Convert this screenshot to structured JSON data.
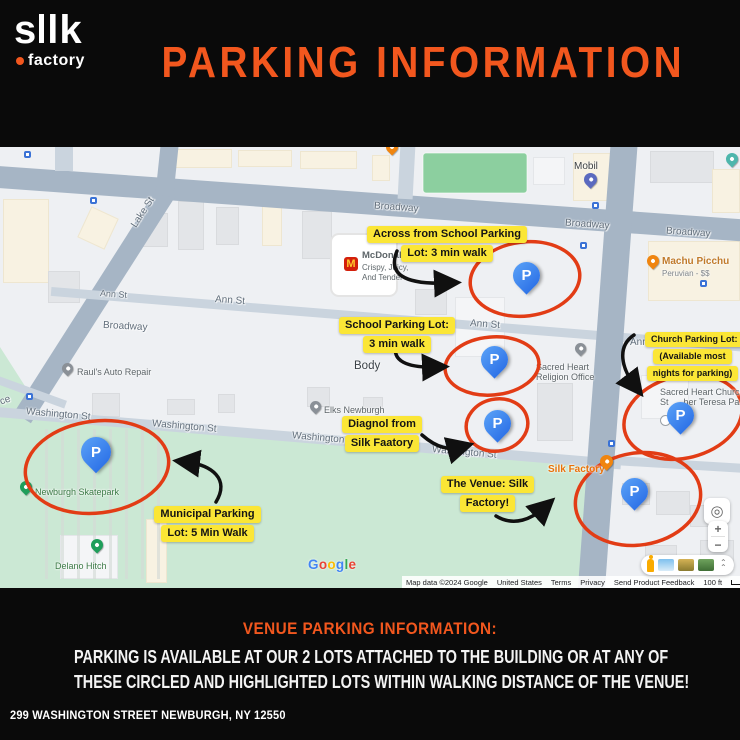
{
  "colors": {
    "accent_orange": "#f2571e",
    "highlight_yellow": "#fbe636",
    "circle_red": "#e23c15",
    "parking_pin_blue": "#4285f4"
  },
  "header": {
    "logo_word_left": "s",
    "logo_word_right": "lk",
    "logo_sub": "factory",
    "title": "PARKING INFORMATION"
  },
  "map": {
    "streets": {
      "broadway": "Broadway",
      "lake": "Lake St",
      "ann": "Ann St",
      "ann_short": "Ann",
      "washington": "Washington St",
      "partial_left": "ce"
    },
    "pois": {
      "mobil": {
        "name": "Mobil"
      },
      "mcdonalds": {
        "name": "McDonald's",
        "line2": "Crispy, Juicy,",
        "line3": "And Tender",
        "icon_letter": "M"
      },
      "machu_picchu": {
        "name": "Machu Picchu",
        "subtitle": "Peruvian - $$"
      },
      "rauls": {
        "name": "Raul's Auto Repair"
      },
      "elks": {
        "name": "Elks Newburgh"
      },
      "sacred_heart_office": {
        "line1": "Sacred Heart",
        "line2": "Religion Office"
      },
      "sacred_heart_church": {
        "line1": "Sacred Heart Church",
        "line2": "St      her Teresa Pa"
      },
      "silk_factory": {
        "name": "Silk Factory"
      },
      "skatepark": {
        "name": "Newburgh Skatepark"
      },
      "delano": {
        "name": "Delano Hitch"
      },
      "body": {
        "name": "Body"
      }
    },
    "parking_pin_letter": "P",
    "annotations": {
      "across": {
        "lines": [
          "Across from School Parking",
          "Lot: 3 min walk"
        ]
      },
      "school": {
        "lines": [
          "School Parking Lot:",
          "3 min walk"
        ]
      },
      "church": {
        "lines": [
          "Church Parking Lot:",
          "(Available most",
          "nights for parking)"
        ]
      },
      "diagnol": {
        "lines": [
          "Diagnol from",
          "Silk Faatory"
        ]
      },
      "venue": {
        "lines": [
          "The Venue: Silk",
          "Factory!"
        ]
      },
      "municipal": {
        "lines": [
          "Municipal Parking",
          "Lot: 5 Min Walk"
        ]
      }
    },
    "controls": {
      "zoom_in": "+",
      "zoom_out": "−",
      "collapse": "⌃"
    },
    "watermark": "Google",
    "attribution": {
      "map_data": "Map data ©2024 Google",
      "region": "United States",
      "terms": "Terms",
      "privacy": "Privacy",
      "feedback": "Send Product Feedback",
      "scale": "100 ft"
    }
  },
  "footer": {
    "heading": "VENUE PARKING INFORMATION:",
    "line1": "PARKING IS AVAILABLE AT OUR 2 LOTS ATTACHED TO THE BUILDING OR AT ANY OF",
    "line2": "THESE CIRCLED AND HIGHLIGHTED LOTS WITHIN WALKING DISTANCE OF THE VENUE!",
    "address": "299 WASHINGTON STREET NEWBURGH, NY 12550"
  }
}
